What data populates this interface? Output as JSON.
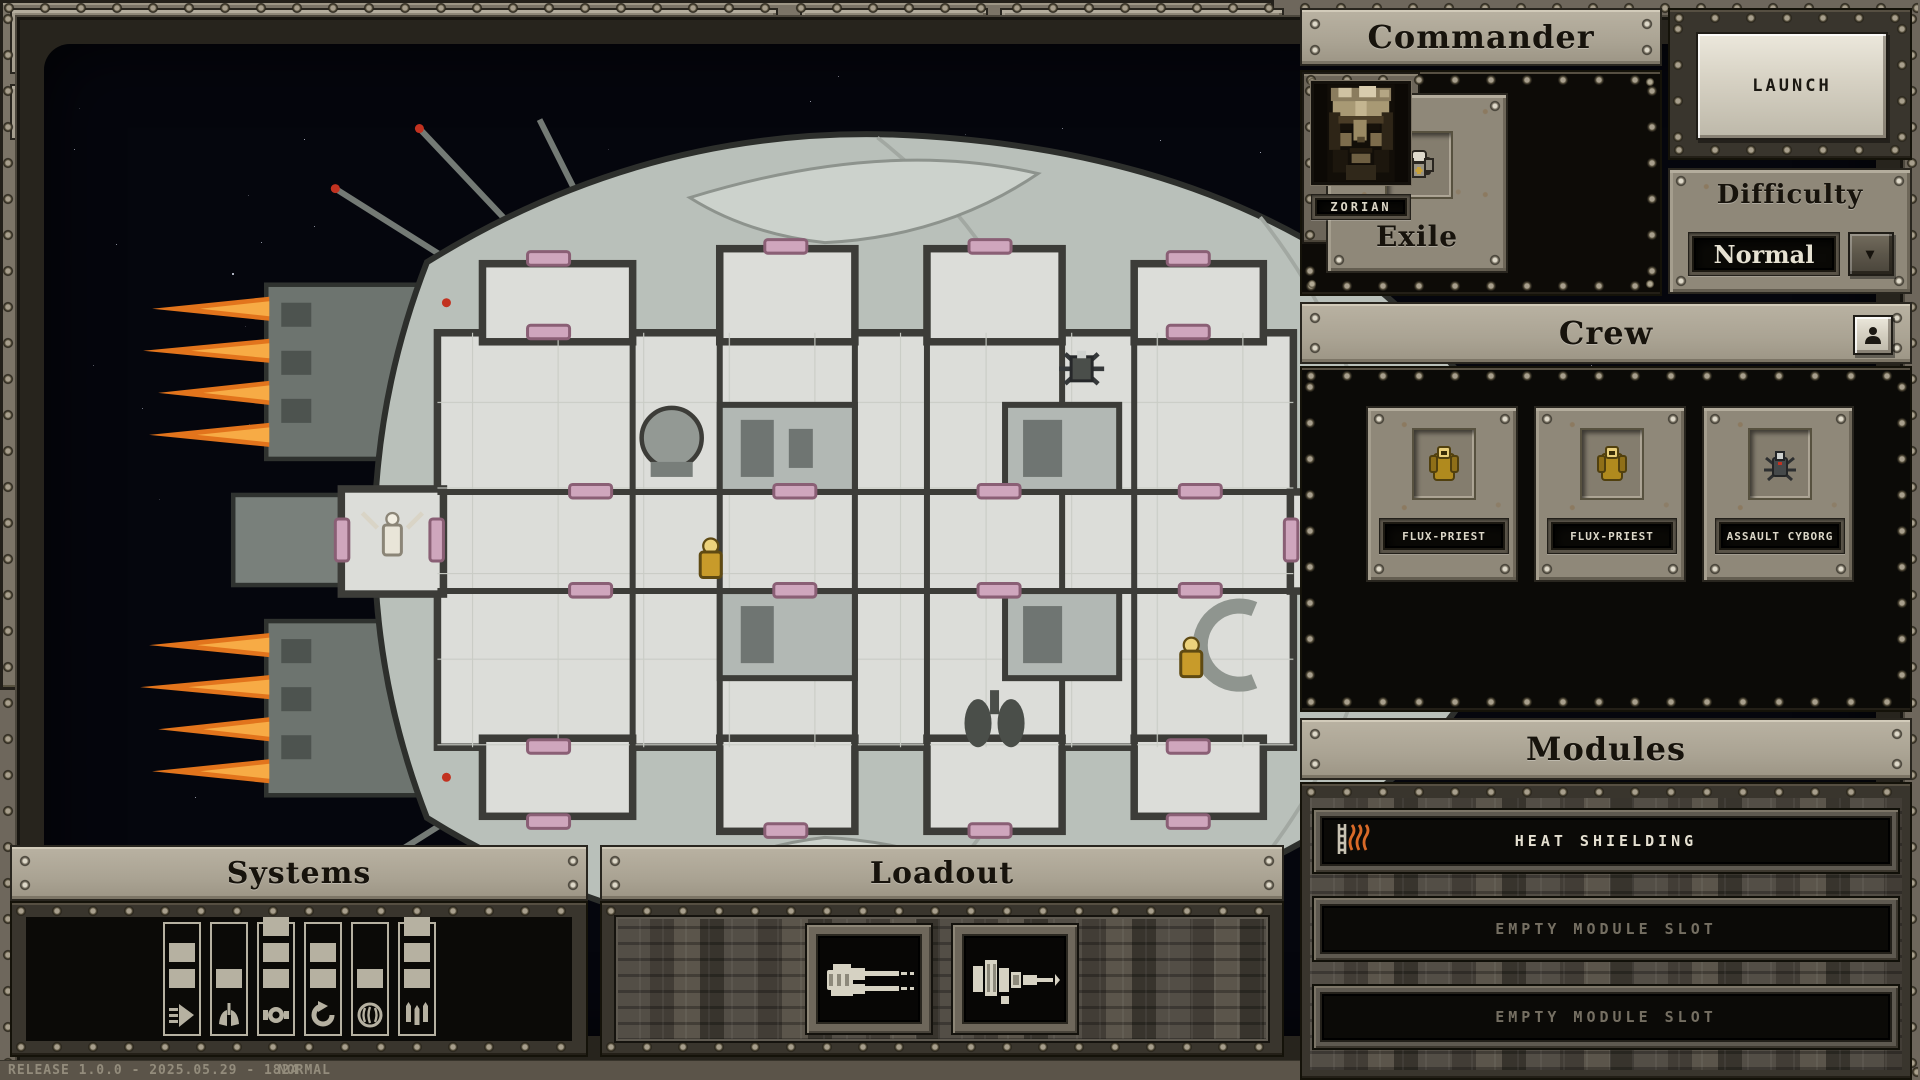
{
  "titlebar": {
    "ship_name": "Fieldpiercer",
    "main_menu": "MAIN MENU",
    "randomize_hull": "RANDOMIZE HULL"
  },
  "toolbar": {
    "view_exterior": "VIEW EXTERIOR",
    "list": "LIST",
    "variants": [
      "A",
      "B",
      "C"
    ],
    "selected_variant": "B",
    "prev_glyph": "◀",
    "next_glyph": "▶",
    "hull_label": "EXPLORATOR B"
  },
  "commander": {
    "title": "Commander",
    "archetype": "Exile",
    "portrait_name": "ZORIAN"
  },
  "launch": {
    "label": "LAUNCH"
  },
  "difficulty": {
    "title": "Difficulty",
    "value": "Normal",
    "dropdown_glyph": "▼"
  },
  "crew": {
    "title": "Crew",
    "members": [
      {
        "name": "FLUX-PRIEST",
        "icon": "flux-priest-sprite"
      },
      {
        "name": "FLUX-PRIEST",
        "icon": "flux-priest-sprite"
      },
      {
        "name": "ASSAULT CYBORG",
        "icon": "assault-cyborg-sprite"
      }
    ]
  },
  "modules": {
    "title": "Modules",
    "slots": [
      {
        "label": "HEAT SHIELDING",
        "filled": true,
        "icon": "heat-shield-icon"
      },
      {
        "label": "EMPTY MODULE SLOT",
        "filled": false
      },
      {
        "label": "EMPTY MODULE SLOT",
        "filled": false
      }
    ]
  },
  "systems": {
    "title": "Systems",
    "gauges": [
      {
        "name": "thrusters",
        "level": 2
      },
      {
        "name": "life-support",
        "level": 1
      },
      {
        "name": "reactor",
        "level": 3
      },
      {
        "name": "maneuvering",
        "level": 2
      },
      {
        "name": "cogitator",
        "level": 1
      },
      {
        "name": "ordnance",
        "level": 3
      }
    ]
  },
  "loadout": {
    "title": "Loadout",
    "weapons": [
      "twin-autocannon",
      "lance-cannon"
    ]
  },
  "statusbar": {
    "release": "RELEASE 1.0.0 - 2025.05.29 - 1824",
    "mode": "NORMAL"
  },
  "colors": {
    "accent_red": "#a03320",
    "flame_orange": "#e2741c",
    "door_pink": "#cfa6bd",
    "crew_yellow": "#c89b2a"
  }
}
